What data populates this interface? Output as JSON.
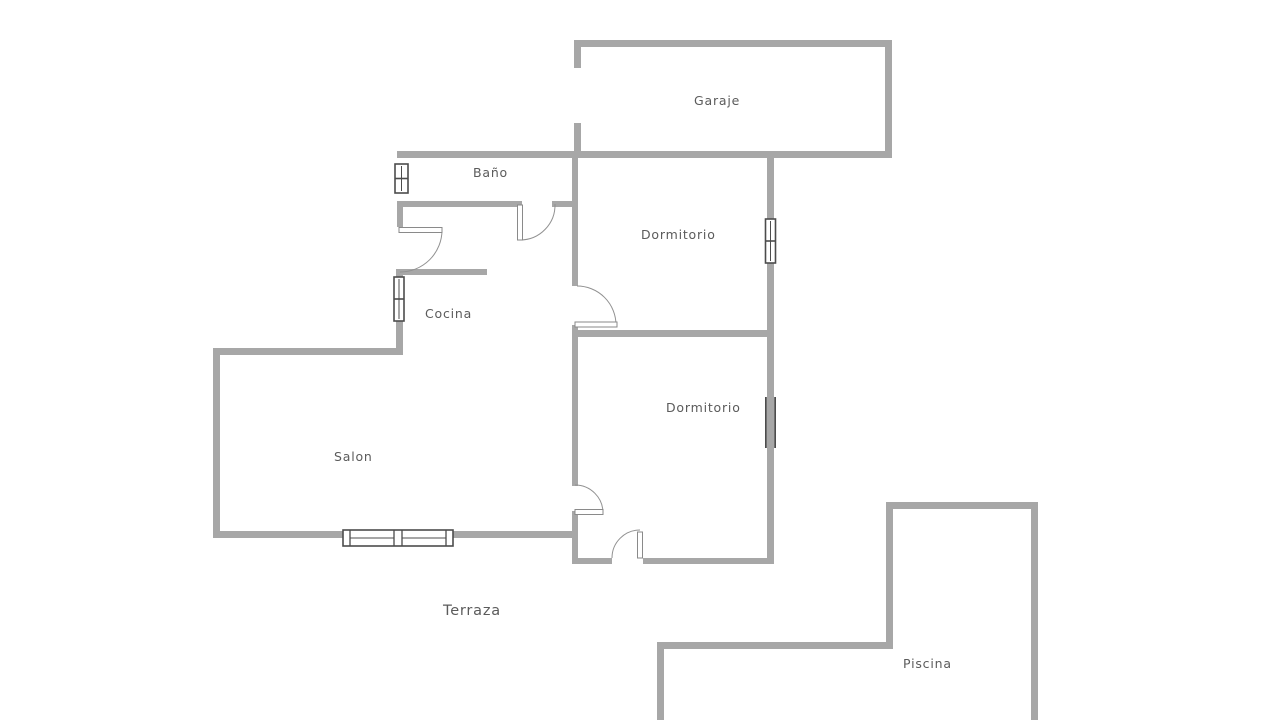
{
  "plan": {
    "type": "residential-floor-plan",
    "background": "#ffffff",
    "room_names": [
      "Garaje",
      "Baño",
      "Dormitorio",
      "Cocina",
      "Salon",
      "Dormitorio",
      "Terraza",
      "Piscina"
    ]
  },
  "colors": {
    "wall": "#a7a7a7",
    "window_frame": "#4c4c4c",
    "window_fill": "#ffffff",
    "door_leaf_stroke": "#8a8a8a",
    "door_leaf_fill": "#ffffff",
    "door_arc": "#919191",
    "label_text": "#5b5b5b"
  },
  "labels": {
    "garaje": {
      "text": "Garaje",
      "x": 694,
      "y": 95,
      "size": 12.5
    },
    "bano": {
      "text": "Baño",
      "x": 473,
      "y": 167,
      "size": 12.5
    },
    "dormitorio_1": {
      "text": "Dormitorio",
      "x": 641,
      "y": 229,
      "size": 12.5
    },
    "cocina": {
      "text": "Cocina",
      "x": 425,
      "y": 308,
      "size": 12.5
    },
    "salon": {
      "text": "Salon",
      "x": 334,
      "y": 451,
      "size": 12.5
    },
    "dormitorio_2": {
      "text": "Dormitorio",
      "x": 666,
      "y": 402,
      "size": 12.5
    },
    "terraza": {
      "text": "Terraza",
      "x": 443,
      "y": 604,
      "size": 14.5
    },
    "piscina": {
      "text": "Piscina",
      "x": 903,
      "y": 658,
      "size": 12.5
    }
  },
  "walls": [
    {
      "name": "garage-wall-top",
      "x": 574,
      "y": 40,
      "w": 318,
      "h": 7
    },
    {
      "name": "garage-wall-right",
      "x": 885,
      "y": 40,
      "w": 7,
      "h": 118
    },
    {
      "name": "garage-wall-left-upper",
      "x": 574,
      "y": 40,
      "w": 7,
      "h": 28
    },
    {
      "name": "garage-wall-left-lower",
      "x": 574,
      "y": 123,
      "w": 7,
      "h": 33
    },
    {
      "name": "bathroom-top-garage-bottom-wall",
      "x": 397,
      "y": 151,
      "w": 495,
      "h": 7
    },
    {
      "name": "spine-wall-upper",
      "x": 572,
      "y": 158,
      "w": 6,
      "h": 128
    },
    {
      "name": "bathroom-wall-bottom",
      "x": 397,
      "y": 201,
      "w": 125,
      "h": 6
    },
    {
      "name": "bathroom-wall-bottom-stub",
      "x": 552,
      "y": 201,
      "w": 26,
      "h": 6
    },
    {
      "name": "kitchen-wall-left-upper",
      "x": 397,
      "y": 201,
      "w": 6,
      "h": 26
    },
    {
      "name": "kitchen-wall-top",
      "x": 396,
      "y": 269,
      "w": 91,
      "h": 6
    },
    {
      "name": "kitchen-wall-left-lower",
      "x": 396,
      "y": 269,
      "w": 7,
      "h": 85
    },
    {
      "name": "livingroom-wall-top",
      "x": 213,
      "y": 348,
      "w": 190,
      "h": 7
    },
    {
      "name": "livingroom-wall-left",
      "x": 213,
      "y": 348,
      "w": 7,
      "h": 190
    },
    {
      "name": "livingroom-wall-bottom",
      "x": 213,
      "y": 531,
      "w": 365,
      "h": 7
    },
    {
      "name": "spine-wall-middle",
      "x": 572,
      "y": 325,
      "w": 6,
      "h": 161
    },
    {
      "name": "spine-wall-lower",
      "x": 572,
      "y": 511,
      "w": 6,
      "h": 53
    },
    {
      "name": "bedrooms-divider-wall",
      "x": 572,
      "y": 330,
      "w": 201,
      "h": 7
    },
    {
      "name": "bedrooms-wall-right",
      "x": 767,
      "y": 156,
      "w": 7,
      "h": 408
    },
    {
      "name": "bedroom2-wall-bottom-left",
      "x": 572,
      "y": 558,
      "w": 40,
      "h": 6
    },
    {
      "name": "bedroom2-wall-bottom-right",
      "x": 643,
      "y": 558,
      "w": 130,
      "h": 6
    },
    {
      "name": "pool-wall-left",
      "x": 886,
      "y": 502,
      "w": 7,
      "h": 146
    },
    {
      "name": "pool-wall-top",
      "x": 886,
      "y": 502,
      "w": 152,
      "h": 7
    },
    {
      "name": "pool-wall-right",
      "x": 1031,
      "y": 502,
      "w": 7,
      "h": 218
    },
    {
      "name": "garden-wall-bottom",
      "x": 657,
      "y": 642,
      "w": 236,
      "h": 7
    },
    {
      "name": "garden-wall-left",
      "x": 657,
      "y": 642,
      "w": 7,
      "h": 78
    }
  ],
  "windows": [
    {
      "name": "bathroom-window",
      "x": 395,
      "y": 164,
      "w": 13,
      "h": 29,
      "orient": "v"
    },
    {
      "name": "kitchen-window",
      "x": 394,
      "y": 277,
      "w": 10,
      "h": 44,
      "orient": "v"
    },
    {
      "name": "bedroom1-window",
      "x": 765.5,
      "y": 219,
      "w": 10,
      "h": 44,
      "orient": "v"
    },
    {
      "name": "livingroom-window",
      "x": 343,
      "y": 530,
      "w": 110,
      "h": 16,
      "orient": "h"
    }
  ],
  "sliding_doors": [
    {
      "name": "bedroom2-sliding-door",
      "x": 765,
      "y": 397,
      "w": 11,
      "h": 51
    }
  ],
  "doors": [
    {
      "name": "bathroom-door",
      "leaf": [
        517.5,
        205,
        5,
        35
      ],
      "arc": "M 520 240 A 35 35 0 0 0 555 204"
    },
    {
      "name": "kitchen-door",
      "leaf": [
        399,
        227.5,
        43,
        5
      ],
      "arc": "M 442 230 A 42 42 0 0 1 400 272"
    },
    {
      "name": "bedroom1-door",
      "leaf": [
        575,
        322,
        42,
        5
      ],
      "arc": "M 577 286 A 39 39 0 0 1 616 325"
    },
    {
      "name": "bedroom2-door",
      "leaf": [
        575,
        509.5,
        28,
        5
      ],
      "arc": "M 575 485 A 28 28 0 0 1 603 513"
    },
    {
      "name": "terrace-door",
      "leaf": [
        637.5,
        532,
        5,
        26
      ],
      "arc": "M 612 558 A 28 28 0 0 1 640 530"
    }
  ]
}
